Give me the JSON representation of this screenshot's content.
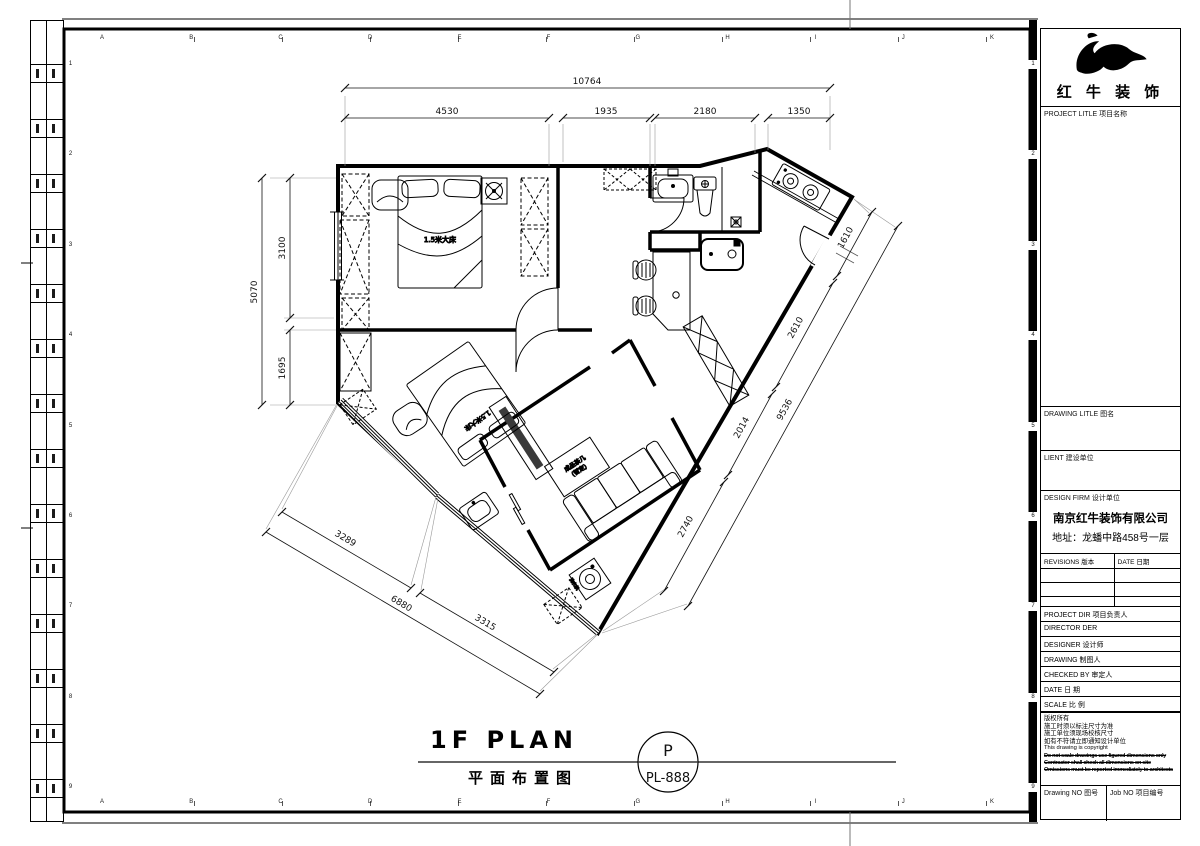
{
  "border": {
    "letters": [
      "A",
      "B",
      "C",
      "D",
      "E",
      "F",
      "G",
      "H",
      "I",
      "J",
      "K"
    ],
    "numbers": [
      "1",
      "2",
      "3",
      "4",
      "5",
      "6",
      "7",
      "8",
      "9"
    ]
  },
  "dims": {
    "top_total": "10764",
    "top": [
      "4530",
      "1935",
      "2180",
      "1350"
    ],
    "left_total": "5070",
    "left": [
      "3100",
      "1695"
    ],
    "bottom_total": "6880",
    "bottom": [
      "3289",
      "3315"
    ],
    "right_total": "9536",
    "right": [
      "1610",
      "2610",
      "2014",
      "2740"
    ]
  },
  "plan": {
    "bed1_label": "1.5米大床",
    "bed2_label": "1.5米大床",
    "coffee_table_line1": "成品茶几",
    "coffee_table_line2": "(暂定)",
    "washer_label": "洗衣机",
    "title_en": "1F PLAN",
    "title_cn": "平面布置图",
    "stamp_letter": "P",
    "stamp_no": "PL-888"
  },
  "titleblock": {
    "brand": "红 牛 装 饰",
    "project_title": "PROJECT LITLE  项目名称",
    "drawing_title": "DRAWING LITLE  图名",
    "client": "LIENT  建设单位",
    "design_firm": "DESIGN FIRM  设计单位",
    "firm_name": "南京红牛装饰有限公司",
    "firm_address": "地址：龙蟠中路458号一层",
    "revisions": "REVISIONS  版本",
    "rev_date": "DATE  日期",
    "rows": [
      "PROJECT DIR  项目负责人",
      "DIRECTOR DER",
      "DESIGNER   设计师",
      "DRAWING   制图人",
      "CHECKED BY  审定人",
      "DATE     日 期",
      "SCALE     比 例"
    ],
    "copyright_cn": [
      "版权所有",
      "施工时须以标注尺寸为准",
      "施工单位须现场校核尺寸",
      "如有不符请立即通知设计单位"
    ],
    "copyright_en": "This drawing is copyright",
    "copyright_bold": [
      "Do not scale drawings use figured dimensions only",
      "Contractor shall check all dimensions on site",
      "Omissions must be reported immediately to architects"
    ],
    "drawing_no": "Drawing NO  图号",
    "job_no": "Job NO  项目编号"
  }
}
